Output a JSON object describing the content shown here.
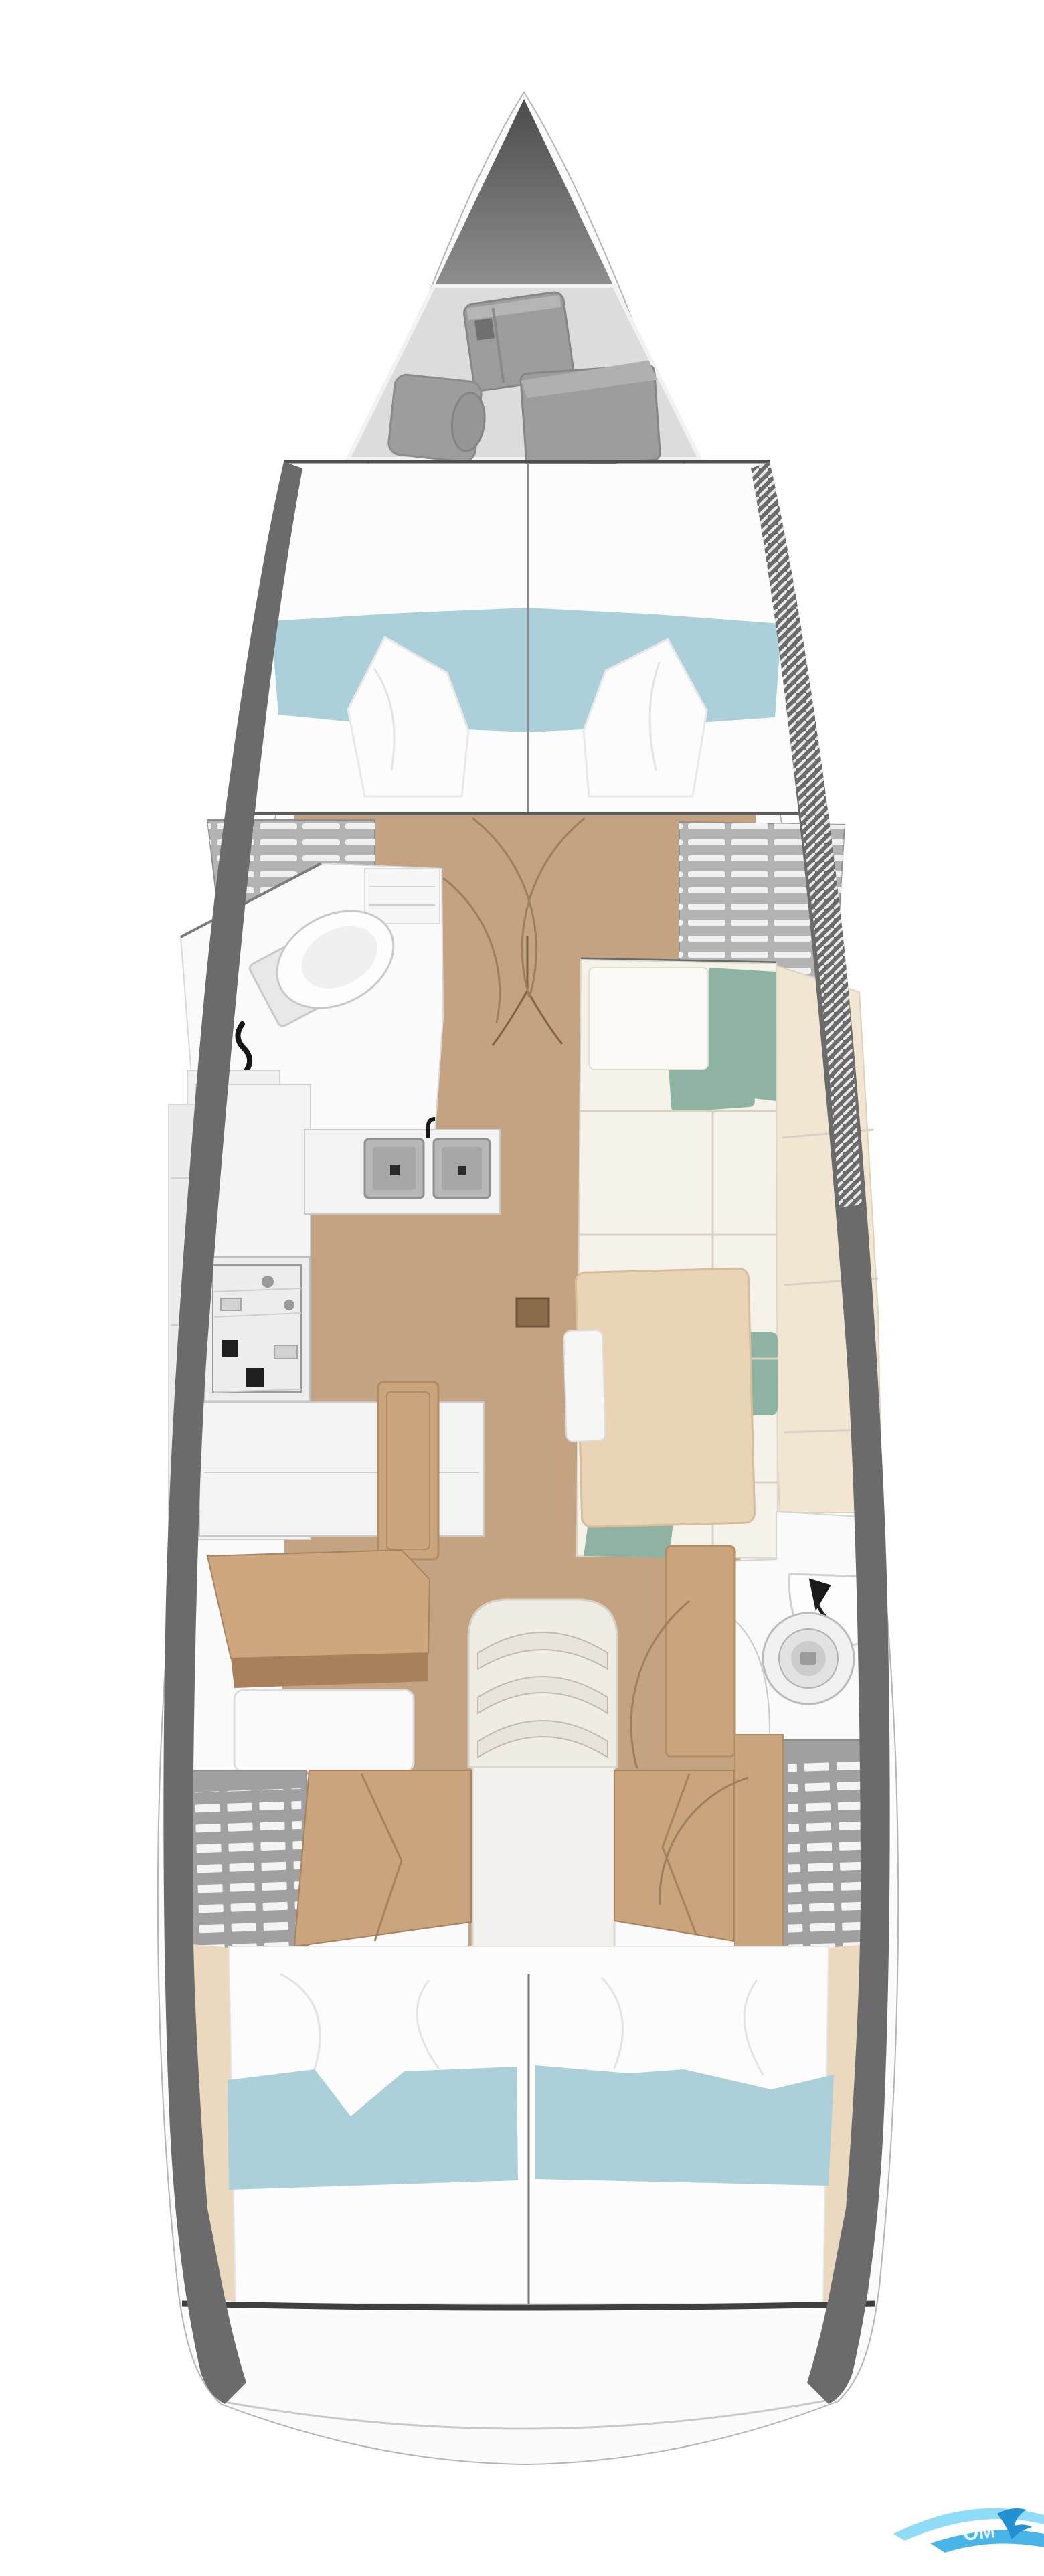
{
  "watermark": {
    "visible_text": "OM"
  },
  "colors": {
    "hull_fill": "#fbfbfb",
    "hull_stroke": "#b5b5b5",
    "hull_band": "#6b6b6b",
    "bow_tip": "#5c5c5c",
    "anchor_locker": "#dcdcdc",
    "gear_box": "#9d9d9d",
    "deck_line": "#4e4e4e",
    "berth_white": "#fcfcfc",
    "blanket_teal": "#abd0d9",
    "floor_wood": "#c4a382",
    "floor_hatch": "#8a6b4a",
    "slat_locker": "#b3b3b3",
    "grid_locker": "#a0a0a0",
    "wood_panel": "#c9a47c",
    "desk_top": "#cfa77f",
    "desk_front": "#a9805b",
    "counter_white": "#f3f3f3",
    "sink_gray": "#b7b7b7",
    "stove_gray": "#ededed",
    "cushion_white": "#f5f2ea",
    "bench_cream": "#f1e6d2",
    "pillow_sage": "#8fb3a2",
    "table_tan": "#e9d4b6",
    "head_white": "#fafafa",
    "fixture_gray": "#e8e8e8",
    "beige_panel": "#ead9bf",
    "stern_line": "#3f3f3f",
    "door_arc": "#9c7f5e",
    "stair_platform": "#f2f1ed",
    "stair_step": "#e7e4da",
    "logo_light": "#8edcf6",
    "logo_mid": "#49b4e8",
    "logo_dark": "#2391cf"
  }
}
